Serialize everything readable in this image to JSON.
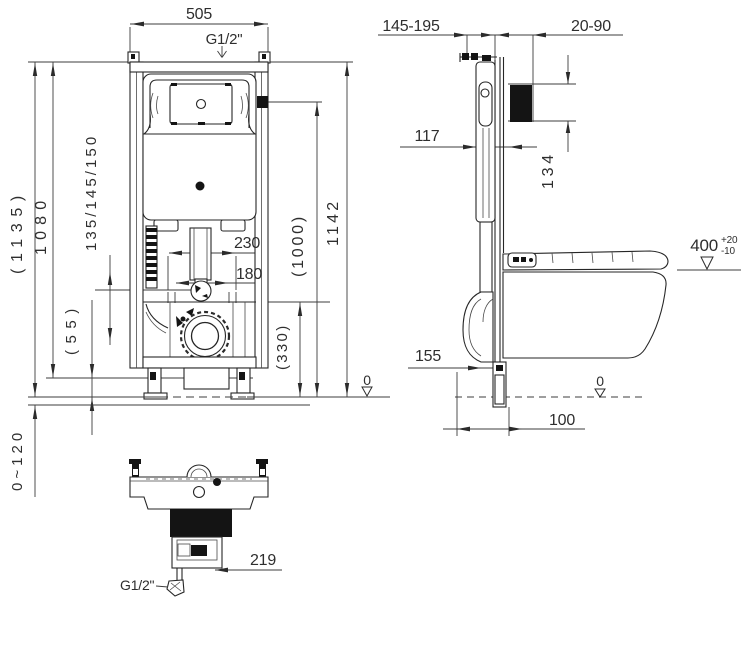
{
  "front_view": {
    "dims": {
      "frame_width": "505",
      "water_inlet": "G1/2\"",
      "height_overall_ref": "(1135)",
      "height_1080": "1080",
      "inlet_height_options": "135/145/150",
      "offset_55": "(55)",
      "fixing_spacing_outer": "230",
      "fixing_spacing_inner": "180",
      "height_1142": "1142",
      "button_height_ref": "(1000)",
      "outlet_height_ref": "(330)",
      "floor_datum": "0",
      "foot_adjustment": "0~120"
    }
  },
  "side_view": {
    "dims": {
      "frame_depth_range": "145-195",
      "wall_thickness_range": "20-90",
      "cistern_depth": "117",
      "access_opening_height": "134",
      "seat_height": "400",
      "seat_height_tol_upper": "+20",
      "seat_height_tol_lower": "-10",
      "bend_depth": "155",
      "outlet_offset": "100",
      "floor_datum": "0"
    }
  },
  "bottom_view": {
    "dims": {
      "offset_219": "219",
      "water_inlet": "G1/2\""
    }
  }
}
